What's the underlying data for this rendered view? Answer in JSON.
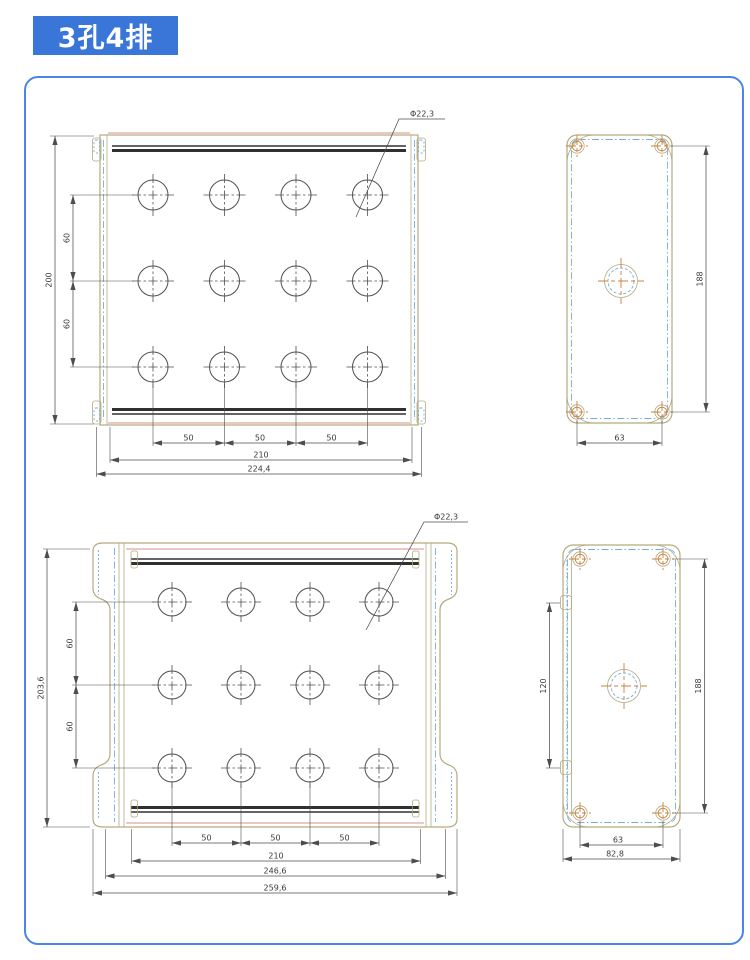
{
  "badge": {
    "label": "3孔4排"
  },
  "colors": {
    "badge_bg": "#3a76d8",
    "panel_border": "#4a86e8",
    "outline_tan": "#b3ab7e",
    "dash_blue": "#74aede",
    "screw_orange": "#c8803f",
    "accent_red": "#d88f8f",
    "band_dark": "#303030"
  },
  "views": {
    "top_front": {
      "grid": {
        "columns": 4,
        "rows": 3
      },
      "dims": {
        "hole_diameter": "Φ22,3",
        "overall_height": "200",
        "hole_pitch_y": [
          "60",
          "60"
        ],
        "hole_pitch_x": [
          "50",
          "50",
          "50"
        ],
        "rail_width": "210",
        "overall_width": "224,4"
      }
    },
    "top_side": {
      "dims": {
        "screw_pitch_v": "188",
        "screw_pitch_h": "63"
      }
    },
    "bottom_front": {
      "grid": {
        "columns": 4,
        "rows": 3
      },
      "dims": {
        "hole_diameter": "Φ22,3",
        "overall_height": "203,6",
        "hole_pitch_y": [
          "60",
          "60"
        ],
        "hole_pitch_x": [
          "50",
          "50",
          "50"
        ],
        "rail_width": "210",
        "flange_width": "246,6",
        "overall_width": "259,6"
      }
    },
    "bottom_side": {
      "dims": {
        "hinge_pitch": "120",
        "screw_pitch_v": "188",
        "screw_pitch_h": "63",
        "overall_depth": "82,8"
      }
    }
  }
}
